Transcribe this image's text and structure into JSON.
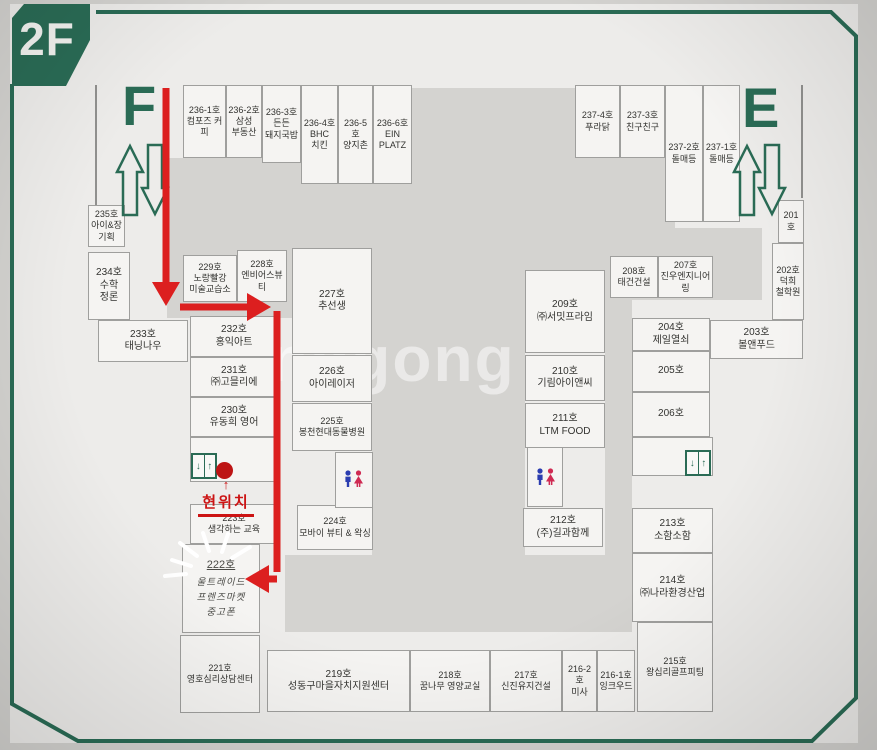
{
  "floor_badge": "2F",
  "stair_west": "F",
  "stair_east": "E",
  "current_location": "현위치",
  "watermark": "onggong",
  "icons": {
    "elevator_down": "↓",
    "elevator_up": "↑",
    "marker_arrow": "↑"
  },
  "colors": {
    "frame_green": "#2a6b55",
    "path_red": "#dc1f1f",
    "man_blue": "#2b3db0",
    "woman_pink": "#cf2a52"
  },
  "rooms": [
    {
      "no": "236-1호",
      "name": "컴포즈 커피",
      "x": 183,
      "y": 85,
      "w": 43,
      "h": 73,
      "cls": "s"
    },
    {
      "no": "236-2호",
      "name": "삼성\n부동산",
      "x": 226,
      "y": 85,
      "w": 36,
      "h": 73,
      "cls": "s"
    },
    {
      "no": "236-3호",
      "name": "든든\n돼지국밥",
      "x": 262,
      "y": 85,
      "w": 39,
      "h": 78,
      "cls": "s"
    },
    {
      "no": "236-4호",
      "name": "BHC\n치킨",
      "x": 301,
      "y": 85,
      "w": 37,
      "h": 99,
      "cls": "s"
    },
    {
      "no": "236-5호",
      "name": "양지촌",
      "x": 338,
      "y": 85,
      "w": 35,
      "h": 99,
      "cls": "s"
    },
    {
      "no": "236-6호",
      "name": "EIN\nPLATZ",
      "x": 373,
      "y": 85,
      "w": 39,
      "h": 99,
      "cls": "s"
    },
    {
      "no": "237-4호",
      "name": "푸라닭",
      "x": 575,
      "y": 85,
      "w": 45,
      "h": 73,
      "cls": "s"
    },
    {
      "no": "237-3호",
      "name": "친구친구",
      "x": 620,
      "y": 85,
      "w": 45,
      "h": 73,
      "cls": "s"
    },
    {
      "no": "237-2호",
      "name": "돌매등",
      "x": 665,
      "y": 85,
      "w": 38,
      "h": 137,
      "cls": "s"
    },
    {
      "no": "237-1호",
      "name": "돌매등",
      "x": 703,
      "y": 85,
      "w": 37,
      "h": 137,
      "cls": "s"
    },
    {
      "no": "235호",
      "name": "아이&장\n기획",
      "x": 88,
      "y": 205,
      "w": 37,
      "h": 42,
      "cls": "s"
    },
    {
      "no": "234호",
      "name": "수학\n정론",
      "x": 88,
      "y": 252,
      "w": 42,
      "h": 68,
      "cls": ""
    },
    {
      "no": "233호",
      "name": "태닝나우",
      "x": 98,
      "y": 320,
      "w": 90,
      "h": 42,
      "cls": ""
    },
    {
      "no": "232호",
      "name": "홍익아트",
      "x": 190,
      "y": 316,
      "w": 88,
      "h": 41,
      "cls": ""
    },
    {
      "no": "231호",
      "name": "㈜고믈리에",
      "x": 190,
      "y": 357,
      "w": 88,
      "h": 40,
      "cls": ""
    },
    {
      "no": "230호",
      "name": "유동희 영어",
      "x": 190,
      "y": 397,
      "w": 88,
      "h": 40,
      "cls": ""
    },
    {
      "no": "",
      "name": "",
      "x": 190,
      "y": 437,
      "w": 88,
      "h": 45,
      "cls": ""
    },
    {
      "no": "223호",
      "name": "생각하는 교육",
      "x": 190,
      "y": 504,
      "w": 88,
      "h": 40,
      "cls": "s"
    },
    {
      "no": "222호",
      "name": "울트레이드\n프렌즈마켓\n중고폰",
      "x": 182,
      "y": 544,
      "w": 78,
      "h": 89,
      "cls": "hand"
    },
    {
      "no": "221호",
      "name": "영호심리상담센터",
      "x": 180,
      "y": 635,
      "w": 80,
      "h": 78,
      "cls": "s"
    },
    {
      "no": "219호",
      "name": "성동구마을자치지원센터",
      "x": 267,
      "y": 650,
      "w": 143,
      "h": 62,
      "cls": ""
    },
    {
      "no": "218호",
      "name": "꿈나무 영양교실",
      "x": 410,
      "y": 650,
      "w": 80,
      "h": 62,
      "cls": "s"
    },
    {
      "no": "217호",
      "name": "신진유지건설",
      "x": 490,
      "y": 650,
      "w": 72,
      "h": 62,
      "cls": "s"
    },
    {
      "no": "216-2호",
      "name": "미사",
      "x": 562,
      "y": 650,
      "w": 35,
      "h": 62,
      "cls": "s"
    },
    {
      "no": "216-1호",
      "name": "잉크우드",
      "x": 597,
      "y": 650,
      "w": 38,
      "h": 62,
      "cls": "s"
    },
    {
      "no": "215호",
      "name": "왕십리골프피팅",
      "x": 637,
      "y": 622,
      "w": 76,
      "h": 90,
      "cls": "s"
    },
    {
      "no": "229호",
      "name": "노랑빨강\n미술교습소",
      "x": 183,
      "y": 255,
      "w": 54,
      "h": 47,
      "cls": "s"
    },
    {
      "no": "228호",
      "name": "엔비어스뷰티",
      "x": 237,
      "y": 250,
      "w": 50,
      "h": 52,
      "cls": "s"
    },
    {
      "no": "227호",
      "name": "추선생",
      "x": 292,
      "y": 248,
      "w": 80,
      "h": 106,
      "cls": ""
    },
    {
      "no": "226호",
      "name": "아이레이저",
      "x": 292,
      "y": 355,
      "w": 80,
      "h": 47,
      "cls": ""
    },
    {
      "no": "225호",
      "name": "봉천현대동물병원",
      "x": 292,
      "y": 403,
      "w": 80,
      "h": 48,
      "cls": "s"
    },
    {
      "no": "224호",
      "name": "모바이 뷰티 & 왁싱",
      "x": 297,
      "y": 505,
      "w": 76,
      "h": 45,
      "cls": "s"
    },
    {
      "no": "209호",
      "name": "㈜서밋프라임",
      "x": 525,
      "y": 270,
      "w": 80,
      "h": 83,
      "cls": ""
    },
    {
      "no": "210호",
      "name": "기림아이앤씨",
      "x": 525,
      "y": 355,
      "w": 80,
      "h": 46,
      "cls": ""
    },
    {
      "no": "211호",
      "name": "LTM FOOD",
      "x": 525,
      "y": 403,
      "w": 80,
      "h": 45,
      "cls": ""
    },
    {
      "no": "212호",
      "name": "(주)길과함께",
      "x": 523,
      "y": 508,
      "w": 80,
      "h": 39,
      "cls": ""
    },
    {
      "no": "208호",
      "name": "태건건설",
      "x": 610,
      "y": 256,
      "w": 48,
      "h": 42,
      "cls": "s"
    },
    {
      "no": "207호",
      "name": "진우엔지니어링",
      "x": 658,
      "y": 256,
      "w": 55,
      "h": 42,
      "cls": "s"
    },
    {
      "no": "201호",
      "name": "",
      "x": 778,
      "y": 200,
      "w": 26,
      "h": 43,
      "cls": "s"
    },
    {
      "no": "202호",
      "name": "덕희\n철학원",
      "x": 772,
      "y": 243,
      "w": 32,
      "h": 77,
      "cls": "s"
    },
    {
      "no": "203호",
      "name": "볼앤푸드",
      "x": 710,
      "y": 320,
      "w": 93,
      "h": 39,
      "cls": ""
    },
    {
      "no": "204호",
      "name": "제일열쇠",
      "x": 632,
      "y": 318,
      "w": 78,
      "h": 33,
      "cls": ""
    },
    {
      "no": "205호",
      "name": "",
      "x": 632,
      "y": 351,
      "w": 78,
      "h": 41,
      "cls": ""
    },
    {
      "no": "206호",
      "name": "",
      "x": 632,
      "y": 392,
      "w": 78,
      "h": 45,
      "cls": ""
    },
    {
      "no": "",
      "name": "",
      "x": 632,
      "y": 437,
      "w": 81,
      "h": 39,
      "cls": ""
    },
    {
      "no": "213호",
      "name": "소함소함",
      "x": 632,
      "y": 508,
      "w": 81,
      "h": 45,
      "cls": ""
    },
    {
      "no": "214호",
      "name": "㈜나라환경산업",
      "x": 632,
      "y": 553,
      "w": 81,
      "h": 69,
      "cls": ""
    }
  ]
}
